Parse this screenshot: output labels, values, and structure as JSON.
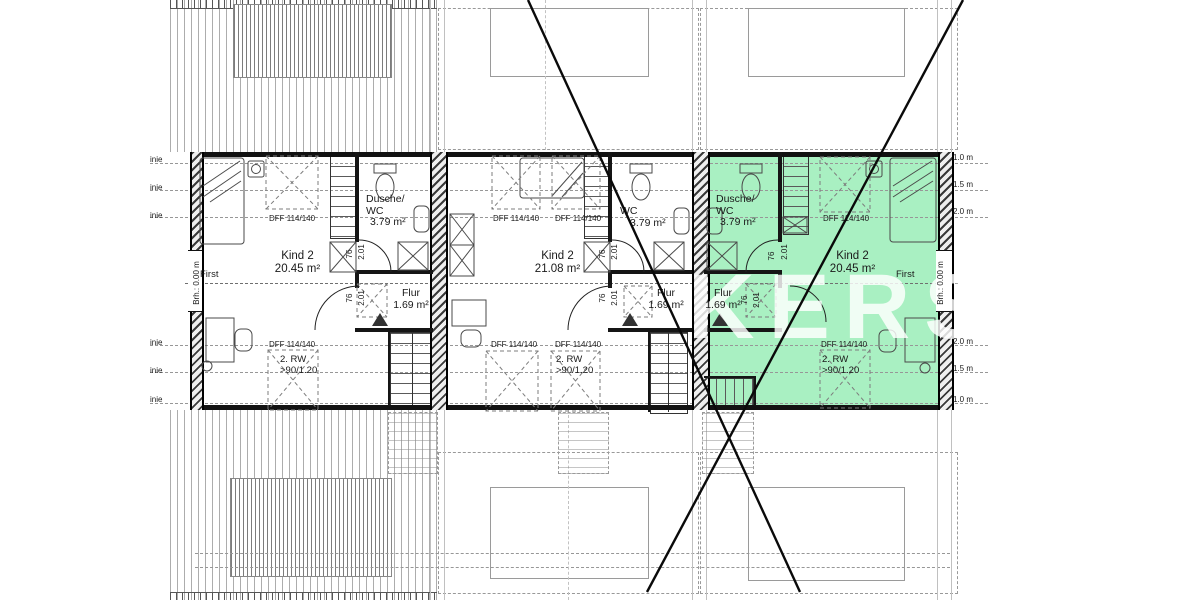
{
  "watermark": {
    "text": "KERS"
  },
  "margins": {
    "left_labels": [
      "inie",
      "inie",
      "inie",
      "inie",
      "inie",
      "inie"
    ],
    "right_labels_top": [
      "1.0 m",
      "1.5 m",
      "2.0 m"
    ],
    "right_labels_bottom": [
      "2.0 m",
      "1.5 m",
      "1.0 m"
    ]
  },
  "ridge": {
    "left_label": "First",
    "right_label": "First",
    "left_height": "Brh.: 0.00 m",
    "right_height": "Brh.: 0.00 m"
  },
  "colors": {
    "highlight": "#a9f0c2"
  },
  "units": [
    {
      "key": "left",
      "room": "Kind 2",
      "area": "20.45 m²",
      "bath1": "Dusche/",
      "bath2": "WC",
      "bath_area": "3.79 m²",
      "hall": "Flur",
      "hall_area": "1.69 m²",
      "dff_top": [
        "DFF 114/140"
      ],
      "dff_bottom": [
        "DFF 114/140"
      ],
      "rw1": "2. RW",
      "rw2": ">90/1.20",
      "door_width": "76",
      "door_height": "2.01"
    },
    {
      "key": "middle",
      "room": "Kind 2",
      "area": "21.08 m²",
      "bath1": "WC",
      "bath2": "",
      "bath_area": "3.79 m²",
      "hall": "Flur",
      "hall_area": "1.69 m²",
      "dff_top": [
        "DFF 114/140",
        "DFF 114/140"
      ],
      "dff_bottom": [
        "DFF 114/140",
        "DFF 114/140"
      ],
      "rw1": "2. RW",
      "rw2": ">90/1.20",
      "door_width": "76",
      "door_height": "2.01"
    },
    {
      "key": "right",
      "room": "Kind 2",
      "area": "20.45 m²",
      "bath1": "Dusche/",
      "bath2": "WC",
      "bath_area": "3.79 m²",
      "hall": "Flur",
      "hall_area": "1.69 m²",
      "dff_top": [
        "DFF 114/140"
      ],
      "dff_bottom": [
        "DFF 114/140"
      ],
      "rw1": "2. RW",
      "rw2": ">90/1.20",
      "door_width": "76",
      "door_height": "2.01",
      "highlighted": true
    }
  ]
}
